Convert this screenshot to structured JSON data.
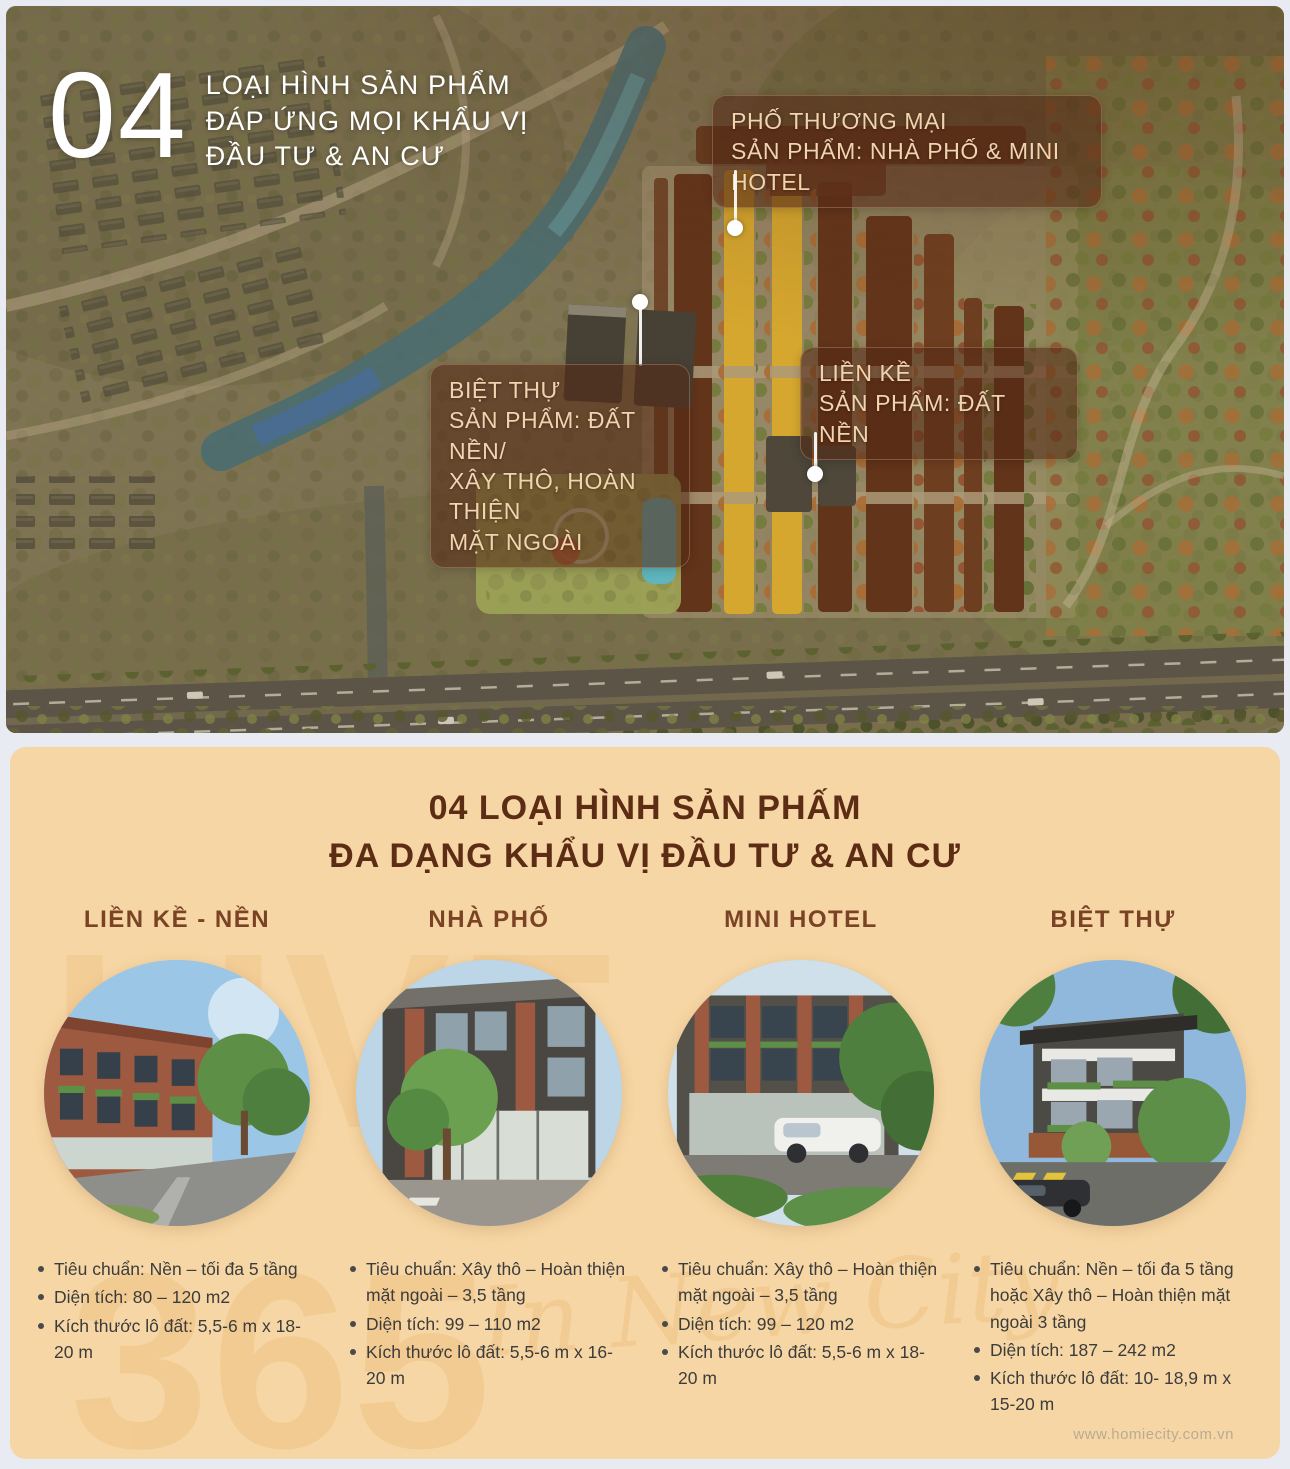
{
  "masterplan": {
    "badge": "04",
    "title": [
      "LOẠI HÌNH SẢN PHẨM",
      "ĐÁP ỨNG MỌI KHẨU VỊ",
      "ĐẦU TƯ & AN CƯ"
    ],
    "callout_pho_thuong_mai": [
      "PHỐ THƯƠNG MẠI",
      "SẢN PHẨM: NHÀ PHỐ & MINI HOTEL"
    ],
    "callout_biet_thu": [
      "BIỆT THỰ",
      "SẢN PHẨM: ĐẤT NỀN/",
      "XÂY THÔ, HOÀN THIỆN",
      "MẶT NGOÀI"
    ],
    "callout_lien_ke": [
      "LIỀN KỀ",
      "SẢN PHẨM: ĐẤT NỀN"
    ]
  },
  "products": {
    "title": [
      "04 LOẠI HÌNH SẢN PHẤM",
      "ĐA DẠNG KHẨU VỊ ĐẦU TƯ & AN CƯ"
    ],
    "watermark": {
      "word": "LIVE",
      "number": "365",
      "script": "In New City"
    },
    "columns": [
      {
        "name": "LIỀN KỀ - NỀN",
        "bullets": [
          "Tiêu chuẩn: Nền – tối đa 5 tầng",
          "Diện tích: 80 – 120 m2",
          "Kích thước lô đất: 5,5-6 m x 18-20 m"
        ]
      },
      {
        "name": "NHÀ PHỐ",
        "bullets": [
          "Tiêu chuẩn: Xây thô – Hoàn thiện mặt ngoài – 3,5 tầng",
          "Diện tích: 99 – 110 m2",
          "Kích thước lô đất: 5,5-6 m x 16-20 m"
        ]
      },
      {
        "name": "MINI HOTEL",
        "bullets": [
          "Tiêu chuẩn: Xây thô – Hoàn thiện mặt ngoài – 3,5 tầng",
          "Diện tích: 99 – 120 m2",
          "Kích thước lô đất: 5,5-6 m x 18-20 m"
        ]
      },
      {
        "name": "BIỆT THỰ",
        "bullets": [
          "Tiêu chuẩn: Nền – tối đa 5 tầng hoặc Xây thô – Hoàn thiện mặt ngoài 3 tầng",
          "Diện tích: 187 – 242 m2",
          "Kích thước lô đất: 10- 18,9 m x 15-20 m"
        ]
      }
    ],
    "footer_url": "www.homiecity.com.vn"
  },
  "colors": {
    "card_bg": "#f6d6a4",
    "title_brown": "#5d2c15",
    "heading_brown": "#7a4325",
    "block_brown": "#5c2e16",
    "block_yellow": "#e3b42e",
    "water_teal": "#41707a",
    "callout_bg": "rgba(84,42,22,.58)"
  }
}
